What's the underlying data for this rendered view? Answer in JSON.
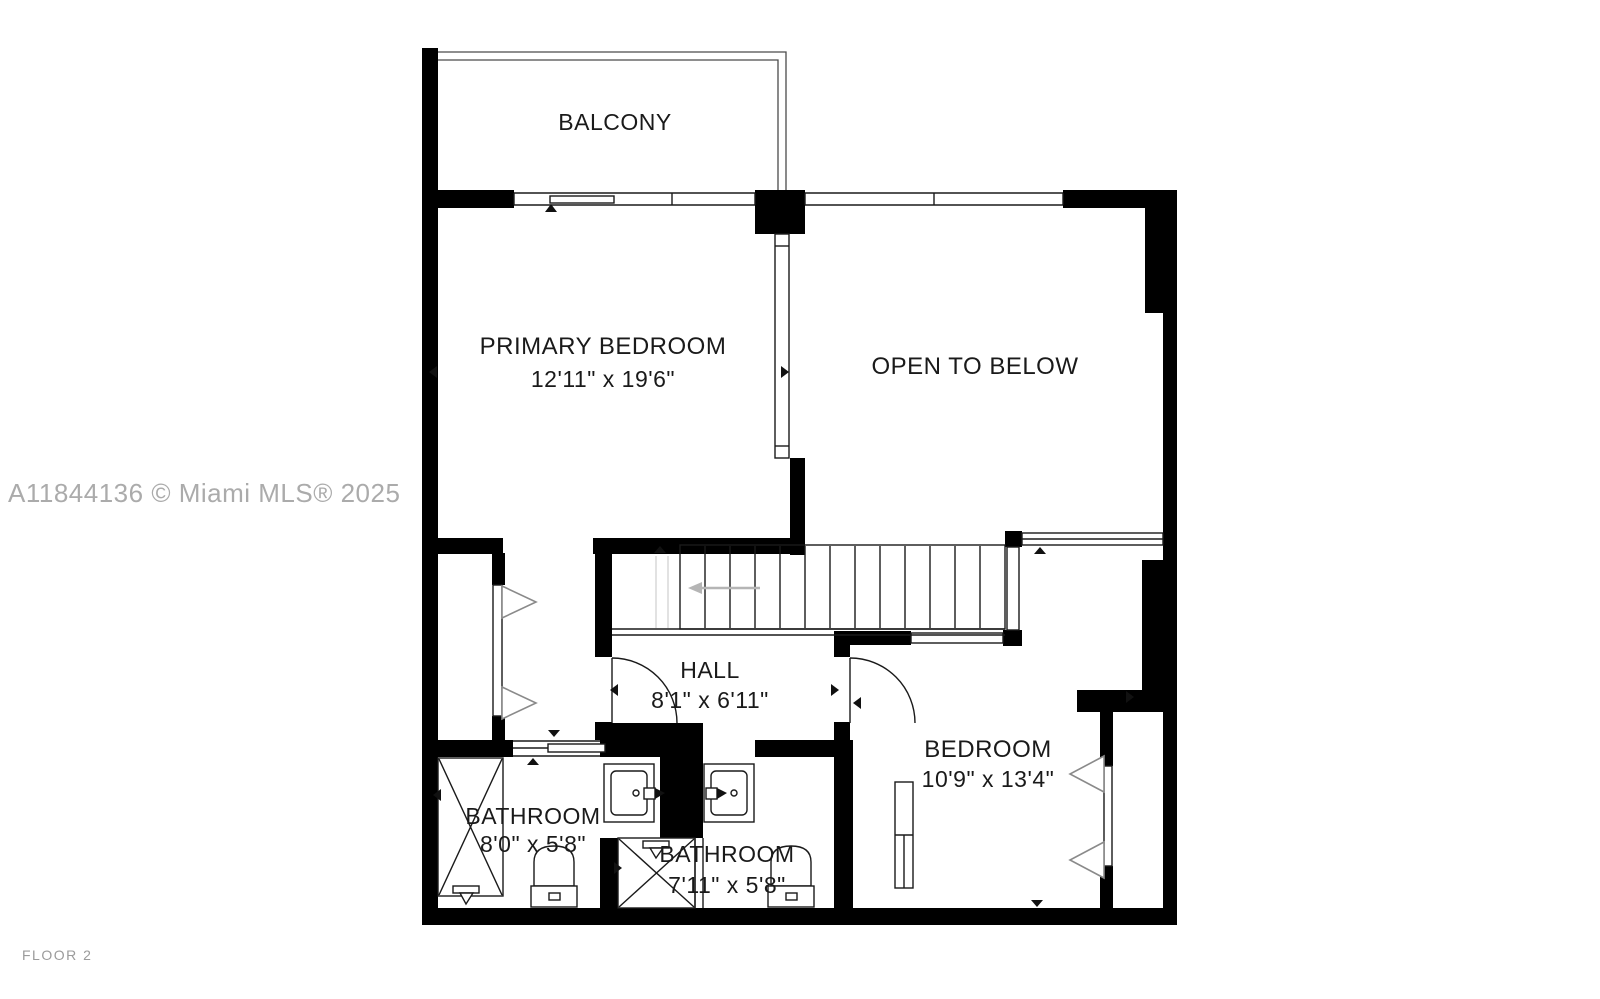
{
  "floorplan": {
    "watermark": "A11844136 © Miami MLS® 2025",
    "floor_label": "FLOOR 2",
    "rooms": [
      {
        "name": "BALCONY",
        "dims": ""
      },
      {
        "name": "PRIMARY BEDROOM",
        "dims": "12'11\" x 19'6\""
      },
      {
        "name": "OPEN TO BELOW",
        "dims": ""
      },
      {
        "name": "HALL",
        "dims": "8'1\" x 6'11\""
      },
      {
        "name": "BEDROOM",
        "dims": "10'9\" x 13'4\""
      },
      {
        "name": "BATHROOM",
        "dims": "8'0\" x 5'8\""
      },
      {
        "name": "BATHROOM",
        "dims": "7'11\" x 5'8\""
      }
    ],
    "fixtures": [
      "stairs",
      "shower",
      "toilet",
      "sink",
      "closet",
      "sliding-door",
      "window",
      "glass-railing"
    ],
    "colors": {
      "walls": "#000000",
      "background": "#ffffff",
      "watermark_text": "#ababab",
      "floor_label_text": "#9b9b9b"
    }
  }
}
